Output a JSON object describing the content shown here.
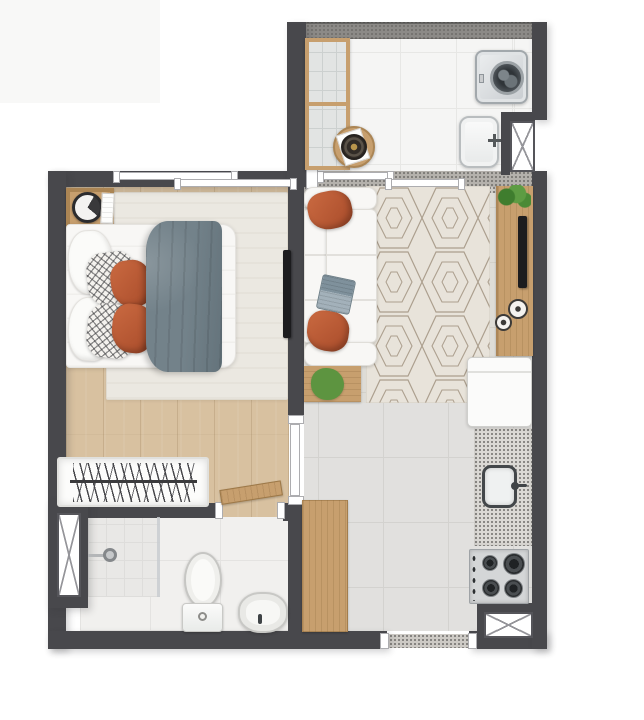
{
  "plan": {
    "name": "furnished-apartment-floor-plan",
    "view": "top-down",
    "visible_text": []
  },
  "colors": {
    "wall": "#48484c",
    "wood_floor": "#d8c1a0",
    "wood": "#c79f6e",
    "tile_white": "#f5f5f4",
    "tile_grey": "#e1e0de",
    "bath_tile": "#f1f0ee",
    "shower_tile": "#e9e8e6",
    "rug_cream": "#ebe8e1",
    "hex_bg": "#e8e3da",
    "hex_line": "#ac9f8e",
    "parapet": "#8c8a87",
    "band": "#b4b1ac",
    "granite": "#dbd9d5",
    "white_furn": "#f8f7f5",
    "terracotta": "#bd5c39",
    "duvet": "#73828a",
    "laptop": "#8fa0ab",
    "tv_black": "#1c1c1e",
    "plant": "#4f8c38",
    "flower": "#e6c52e",
    "steel": "#dcdfe1",
    "drum": "#363b40"
  },
  "rooms": [
    {
      "id": "bedroom",
      "items": [
        "double-bed",
        "white-pillows",
        "patterned-pillows",
        "terracotta-pillows",
        "grey-duvet",
        "nightstand",
        "alarm-clock",
        "book",
        "area-rug",
        "wall-mounted-tv",
        "clothes-rack-with-hangers",
        "sliding-window"
      ]
    },
    {
      "id": "bathroom",
      "items": [
        "walk-in-shower",
        "glass-partition",
        "floor-drain",
        "toilet",
        "round-washbasin",
        "duct-shaft",
        "swing-door"
      ]
    },
    {
      "id": "living-room",
      "items": [
        "three-seat-sofa",
        "terracotta-cushions",
        "laptop",
        "geometric-rug",
        "flower-side-table",
        "tv-sideboard",
        "wall-mounted-tv",
        "potted-plant",
        "decor-vases"
      ]
    },
    {
      "id": "kitchen",
      "items": [
        "refrigerator",
        "granite-counter-with-sink",
        "four-burner-cooktop",
        "wooden-counter-table",
        "duct-shaft",
        "entry-threshold"
      ]
    },
    {
      "id": "service-area",
      "items": [
        "glass-front-cabinet",
        "round-side-table",
        "serving-tray",
        "washing-machine",
        "laundry-tub",
        "duct-shaft",
        "sliding-door"
      ]
    }
  ]
}
